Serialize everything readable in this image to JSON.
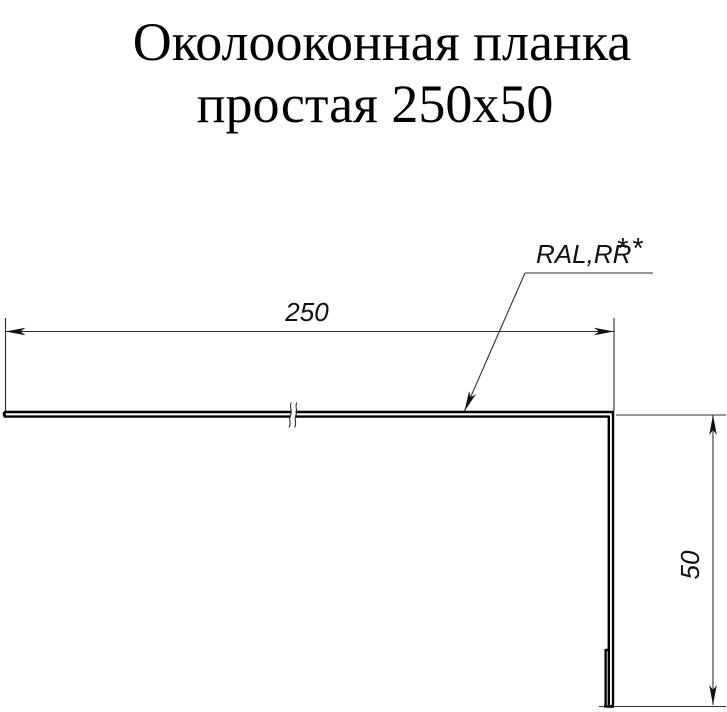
{
  "title": {
    "line1": "Околооконная планка",
    "line2": "простая 250х50"
  },
  "drawing": {
    "width_dim": {
      "label": "250"
    },
    "height_dim": {
      "label": "50"
    },
    "coating": {
      "label": "RAL,RR",
      "stars": "**"
    },
    "colors": {
      "object_line": "#000000",
      "thin_line": "#2e2e2e",
      "arrow_fill": "#111111",
      "background": "#ffffff"
    }
  }
}
